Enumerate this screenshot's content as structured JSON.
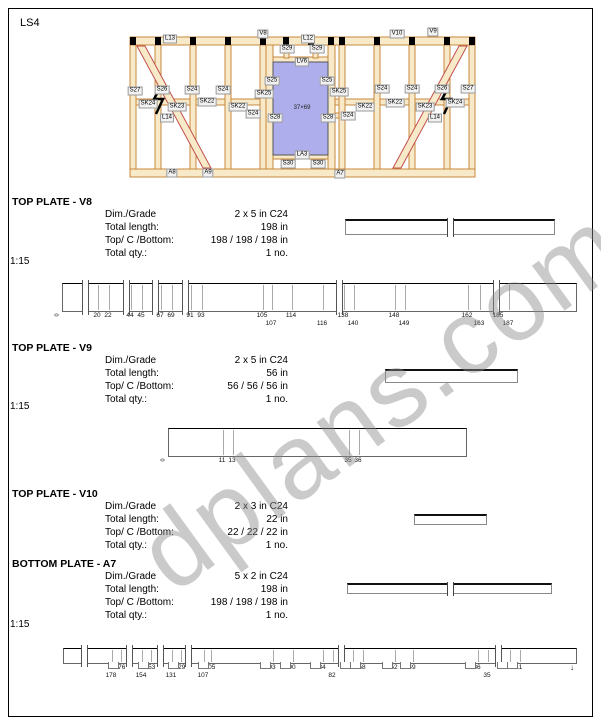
{
  "page": {
    "code": "LS4",
    "watermark": "dplans.com"
  },
  "diagram": {
    "window_size_label": "37×69",
    "labels": [
      {
        "t": "L13",
        "x": 170,
        "y": 39
      },
      {
        "t": "V8",
        "x": 263,
        "y": 34
      },
      {
        "t": "L12",
        "x": 308,
        "y": 39
      },
      {
        "t": "V10",
        "x": 397,
        "y": 34
      },
      {
        "t": "V9",
        "x": 433,
        "y": 32
      },
      {
        "t": "S29",
        "x": 287,
        "y": 49
      },
      {
        "t": "S29",
        "x": 317,
        "y": 49
      },
      {
        "t": "LV6",
        "x": 302,
        "y": 62
      },
      {
        "t": "S25",
        "x": 272,
        "y": 81
      },
      {
        "t": "S25",
        "x": 327,
        "y": 81
      },
      {
        "t": "S27",
        "x": 135,
        "y": 91
      },
      {
        "t": "S26",
        "x": 162,
        "y": 90
      },
      {
        "t": "S24",
        "x": 192,
        "y": 90
      },
      {
        "t": "S24",
        "x": 223,
        "y": 90
      },
      {
        "t": "SK25",
        "x": 264,
        "y": 94
      },
      {
        "t": "SK25",
        "x": 339,
        "y": 92
      },
      {
        "t": "S24",
        "x": 382,
        "y": 89
      },
      {
        "t": "S24",
        "x": 412,
        "y": 89
      },
      {
        "t": "S26",
        "x": 442,
        "y": 89
      },
      {
        "t": "S27",
        "x": 468,
        "y": 89
      },
      {
        "t": "SK24",
        "x": 148,
        "y": 104
      },
      {
        "t": "SK23",
        "x": 177,
        "y": 107
      },
      {
        "t": "SK22",
        "x": 207,
        "y": 102
      },
      {
        "t": "SK22",
        "x": 238,
        "y": 107
      },
      {
        "t": "SK22",
        "x": 365,
        "y": 107
      },
      {
        "t": "SK22",
        "x": 395,
        "y": 103
      },
      {
        "t": "SK23",
        "x": 425,
        "y": 107
      },
      {
        "t": "SK24",
        "x": 455,
        "y": 103
      },
      {
        "t": "L14",
        "x": 167,
        "y": 118
      },
      {
        "t": "S24",
        "x": 253,
        "y": 114
      },
      {
        "t": "S28",
        "x": 275,
        "y": 118
      },
      {
        "t": "S28",
        "x": 328,
        "y": 118
      },
      {
        "t": "S24",
        "x": 348,
        "y": 116
      },
      {
        "t": "L14",
        "x": 435,
        "y": 118
      },
      {
        "t": "LA3",
        "x": 302,
        "y": 155
      },
      {
        "t": "S30",
        "x": 288,
        "y": 164
      },
      {
        "t": "S30",
        "x": 318,
        "y": 164
      },
      {
        "t": "A8",
        "x": 172,
        "y": 173
      },
      {
        "t": "A9",
        "x": 208,
        "y": 173
      },
      {
        "t": "A7",
        "x": 340,
        "y": 174
      }
    ]
  },
  "sections": [
    {
      "title": "TOP PLATE - V8",
      "rows": [
        [
          "Dim./Grade",
          "2 x 5 in C24"
        ],
        [
          "Total length:",
          "198 in"
        ],
        [
          "Top/ C /Bottom:",
          "198 / 198 / 198 in"
        ],
        [
          "Total qty.:",
          "1 no."
        ]
      ]
    },
    {
      "title": "TOP PLATE - V9",
      "rows": [
        [
          "Dim./Grade",
          "2 x 5 in C24"
        ],
        [
          "Total length:",
          "56 in"
        ],
        [
          "Top/ C /Bottom:",
          "56 / 56 / 56 in"
        ],
        [
          "Total qty.:",
          "1 no."
        ]
      ]
    },
    {
      "title": "TOP PLATE - V10",
      "rows": [
        [
          "Dim./Grade",
          "2 x 3 in C24"
        ],
        [
          "Total length:",
          "22 in"
        ],
        [
          "Top/ C /Bottom:",
          "22 / 22 / 22 in"
        ],
        [
          "Total qty.:",
          "1 no."
        ]
      ]
    },
    {
      "title": "BOTTOM PLATE - A7",
      "rows": [
        [
          "Dim./Grade",
          "5 x 2 in C24"
        ],
        [
          "Total length:",
          "198 in"
        ],
        [
          "Top/ C /Bottom:",
          "198 / 198 / 198 in"
        ],
        [
          "Total qty.:",
          "1 no."
        ]
      ]
    }
  ],
  "previews": [
    {
      "x": 345,
      "y": 219,
      "w": 208,
      "h": 13,
      "break_x": 449
    },
    {
      "x": 385,
      "y": 369,
      "w": 131,
      "h": 11
    },
    {
      "x": 414,
      "y": 514,
      "w": 71,
      "h": 8
    },
    {
      "x": 347,
      "y": 583,
      "w": 203,
      "h": 8,
      "break_x": 449
    }
  ],
  "scale_drawings": [
    {
      "scale": "1:15",
      "bar": {
        "x": 62,
        "y": 283,
        "w": 513,
        "h": 27
      },
      "breaks": [
        84,
        125,
        154,
        184,
        338,
        495
      ],
      "upper": [
        {
          "t": "20",
          "x": 97
        },
        {
          "t": "22",
          "x": 108
        },
        {
          "t": "44",
          "x": 130
        },
        {
          "t": "45",
          "x": 141
        },
        {
          "t": "67",
          "x": 160
        },
        {
          "t": "69",
          "x": 171
        },
        {
          "t": "91",
          "x": 190
        },
        {
          "t": "93",
          "x": 201
        },
        {
          "t": "105",
          "x": 262
        },
        {
          "t": "114",
          "x": 291
        },
        {
          "t": "138",
          "x": 343
        },
        {
          "t": "148",
          "x": 394
        },
        {
          "t": "162",
          "x": 467
        },
        {
          "t": "185",
          "x": 498
        }
      ],
      "lower": [
        {
          "t": "107",
          "x": 271
        },
        {
          "t": "116",
          "x": 322
        },
        {
          "t": "140",
          "x": 353
        },
        {
          "t": "149",
          "x": 404
        },
        {
          "t": "163",
          "x": 479
        },
        {
          "t": "187",
          "x": 508
        }
      ],
      "origin": "0"
    },
    {
      "scale": "1:15",
      "bar": {
        "x": 168,
        "y": 428,
        "w": 297,
        "h": 27
      },
      "breaks": [],
      "upper": [
        {
          "t": "11",
          "x": 222
        },
        {
          "t": "13",
          "x": 232
        },
        {
          "t": "35",
          "x": 348
        },
        {
          "t": "36",
          "x": 358
        }
      ],
      "lower": [],
      "origin": "0"
    },
    {
      "scale": "1:15",
      "bar": {
        "x": 63,
        "y": 648,
        "w": 512,
        "h": 14
      },
      "breaks": [
        83,
        128,
        159,
        187,
        340,
        497
      ],
      "upper": [
        {
          "t": "176",
          "x": 120
        },
        {
          "t": "153",
          "x": 150
        },
        {
          "t": "129",
          "x": 180
        },
        {
          "t": "105",
          "x": 210
        },
        {
          "t": "93",
          "x": 272
        },
        {
          "t": "90",
          "x": 292
        },
        {
          "t": "84",
          "x": 322
        },
        {
          "t": "60",
          "x": 352
        },
        {
          "t": "58",
          "x": 362
        },
        {
          "t": "52",
          "x": 394
        },
        {
          "t": "49",
          "x": 412
        },
        {
          "t": "36",
          "x": 477
        },
        {
          "t": "13",
          "x": 509
        },
        {
          "t": "11",
          "x": 519
        }
      ],
      "lower": [
        {
          "t": "178",
          "x": 111
        },
        {
          "t": "154",
          "x": 141
        },
        {
          "t": "131",
          "x": 171
        },
        {
          "t": "107",
          "x": 203
        },
        {
          "t": "82",
          "x": 332
        },
        {
          "t": "35",
          "x": 487
        }
      ],
      "notches": true,
      "end_arrow": true
    }
  ]
}
